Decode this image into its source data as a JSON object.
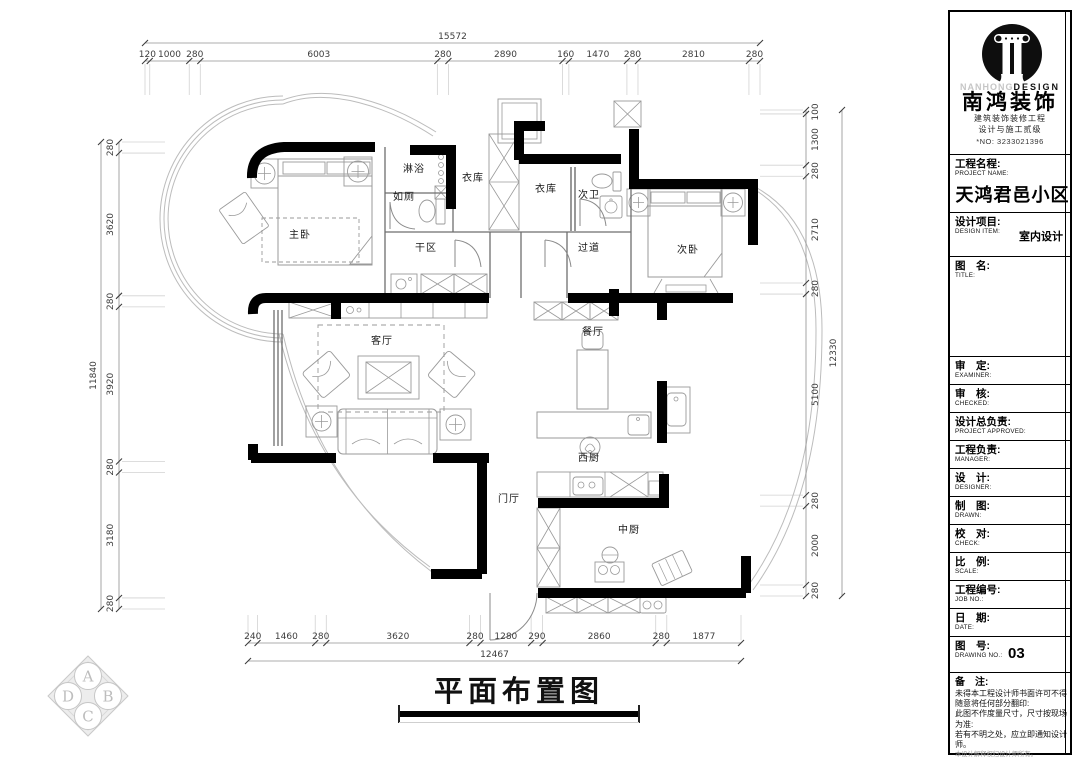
{
  "drawing_title": "平面布置图",
  "rooms": [
    {
      "name": "主卧",
      "x": 300,
      "y": 238
    },
    {
      "name": "淋浴",
      "x": 414,
      "y": 172
    },
    {
      "name": "如厕",
      "x": 404,
      "y": 200
    },
    {
      "name": "衣库",
      "x": 473,
      "y": 181
    },
    {
      "name": "衣库",
      "x": 546,
      "y": 192
    },
    {
      "name": "次卫",
      "x": 589,
      "y": 198
    },
    {
      "name": "次卧",
      "x": 688,
      "y": 253
    },
    {
      "name": "干区",
      "x": 426,
      "y": 251
    },
    {
      "name": "过道",
      "x": 589,
      "y": 251
    },
    {
      "name": "客厅",
      "x": 382,
      "y": 344
    },
    {
      "name": "餐厅",
      "x": 593,
      "y": 335
    },
    {
      "name": "西厨",
      "x": 589,
      "y": 461
    },
    {
      "name": "门厅",
      "x": 509,
      "y": 502
    },
    {
      "name": "中厨",
      "x": 629,
      "y": 533
    }
  ],
  "dimensions": {
    "top": {
      "total": "15572",
      "segments": [
        "120",
        "1000",
        "280",
        "6003",
        "280",
        "2890",
        "160",
        "1470",
        "280",
        "2810",
        "280"
      ]
    },
    "bottom": {
      "total": "12467",
      "segments": [
        "240",
        "1460",
        "280",
        "3620",
        "280",
        "1280",
        "290",
        "2860",
        "280",
        "1877"
      ]
    },
    "left": {
      "total": "11840",
      "segments": [
        "280",
        "3620",
        "280",
        "3920",
        "280",
        "3180",
        "280"
      ]
    },
    "right": {
      "total": "12330",
      "segments": [
        "100",
        "1300",
        "280",
        "2710",
        "280",
        "5100",
        "280",
        "2000",
        "280"
      ]
    }
  },
  "title_block": {
    "brand": {
      "en_gray": "NANHONG",
      "en_black": "DESIGN",
      "cn": "南鸿装饰",
      "cert1": "建筑装饰装修工程",
      "cert2": "设计与施工贰级",
      "cert_no": "*NO: 3233021396"
    },
    "fields": [
      {
        "cn": "工程名程:",
        "en": "PROJECT NAME:",
        "value": "天鸿君邑小区",
        "type": "project"
      },
      {
        "cn": "设计项目:",
        "en": "DESIGN ITEM:",
        "value": "室内设计",
        "type": "item"
      },
      {
        "cn": "图　名:",
        "en": "TITLE:",
        "value": "",
        "type": "title"
      },
      {
        "cn": "审　定:",
        "en": "EXAMINER:",
        "value": "",
        "type": "std"
      },
      {
        "cn": "审　核:",
        "en": "CHECKED:",
        "value": "",
        "type": "std"
      },
      {
        "cn": "设计总负责:",
        "en": "PROJECT APPROVED:",
        "value": "",
        "type": "std"
      },
      {
        "cn": "工程负责:",
        "en": "MANAGER:",
        "value": "",
        "type": "std"
      },
      {
        "cn": "设　计:",
        "en": "DESIGNER:",
        "value": "",
        "type": "std"
      },
      {
        "cn": "制　图:",
        "en": "DRAWN:",
        "value": "",
        "type": "std"
      },
      {
        "cn": "校　对:",
        "en": "CHECK:",
        "value": "",
        "type": "std"
      },
      {
        "cn": "比　例:",
        "en": "SCALE:",
        "value": "",
        "type": "std"
      },
      {
        "cn": "工程编号:",
        "en": "JOB NO.:",
        "value": "",
        "type": "std"
      },
      {
        "cn": "日　期:",
        "en": "DATE:",
        "value": "",
        "type": "std"
      },
      {
        "cn": "图　号:",
        "en": "DRAWING NO.:",
        "value": "03",
        "type": "no"
      }
    ],
    "remarks_title": "备　注:",
    "remarks": [
      "未得本工程设计师书面许可不得",
      "随意将任何部分翻印:",
      "此图不作度量尺寸，尺寸按现场",
      "为准:",
      "若有不明之处，应立即通知设计",
      "师。"
    ],
    "remarks_small": "本设计解释权归设计师所有。",
    "hotline": "免费质询电话:400 8383 168"
  },
  "corner_logo": {
    "letters": [
      "A",
      "D",
      "B",
      "C"
    ]
  }
}
